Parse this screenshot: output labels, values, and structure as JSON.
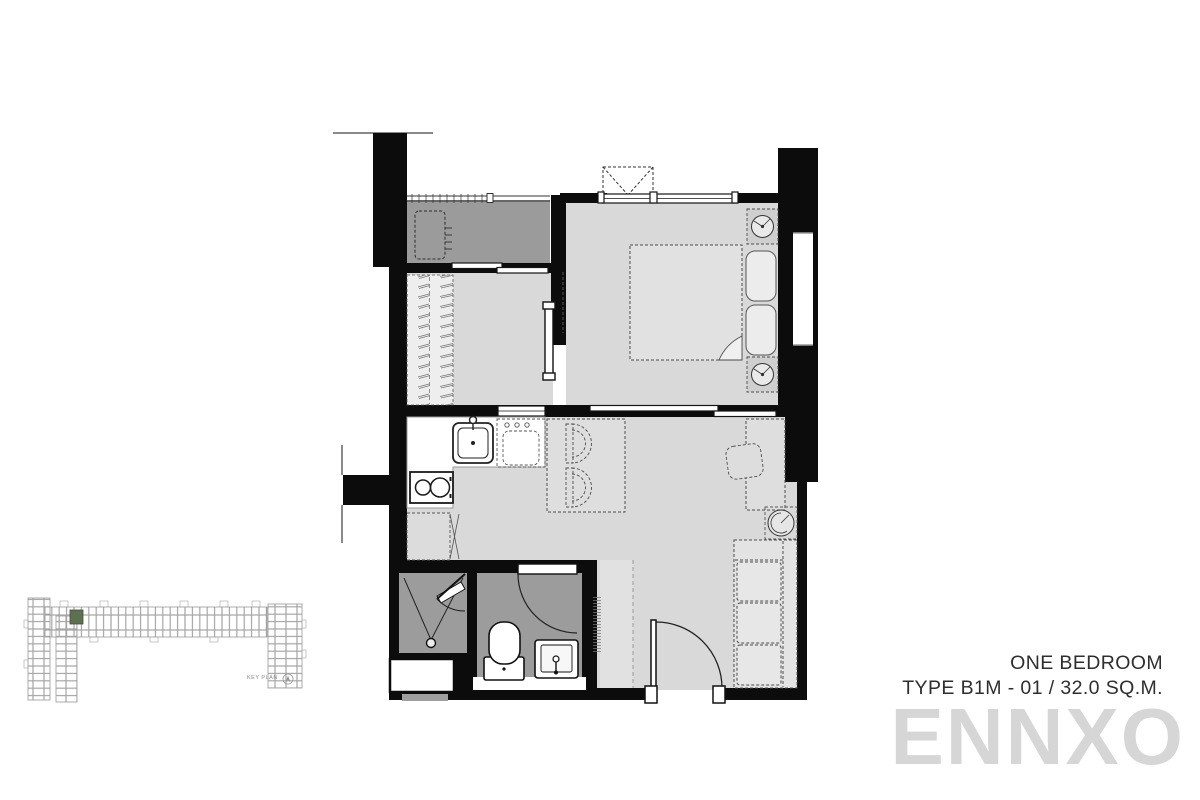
{
  "header": {
    "title": "ONE BEDROOM",
    "subtitle": "TYPE B1M - 01 / 32.0 SQ.M.",
    "unit_type": "B1M",
    "unit_number": "01",
    "area_sqm": "32.0"
  },
  "watermark": "ENNXO",
  "key_plan": {
    "label": "KEY PLAN"
  },
  "colors": {
    "wall": "#0c0c0c",
    "room_floor": "#d9d9d9",
    "balcony_floor": "#9b9b9b",
    "bathroom_floor": "#9c9c9c",
    "entry_floor": "#e1e1e1",
    "keyplan_highlight": "#5d7150",
    "watermark_gray": "#d6d6d6",
    "title_text": "#2e2e2e"
  },
  "fixtures": [
    "balcony-ac-condenser",
    "balcony-railing",
    "wardrobe-hangers",
    "bedroom-sliding-door",
    "ceiling-ac-unit",
    "double-bed",
    "pillows",
    "nightstand-lamps",
    "window",
    "kitchen-sink",
    "washing-machine",
    "two-burner-stove",
    "fridge",
    "dining-table",
    "dining-chairs",
    "desk",
    "desk-chair",
    "plant",
    "sofa",
    "entrance-door",
    "shower",
    "toilet",
    "vanity-basin",
    "ac-ledge"
  ]
}
